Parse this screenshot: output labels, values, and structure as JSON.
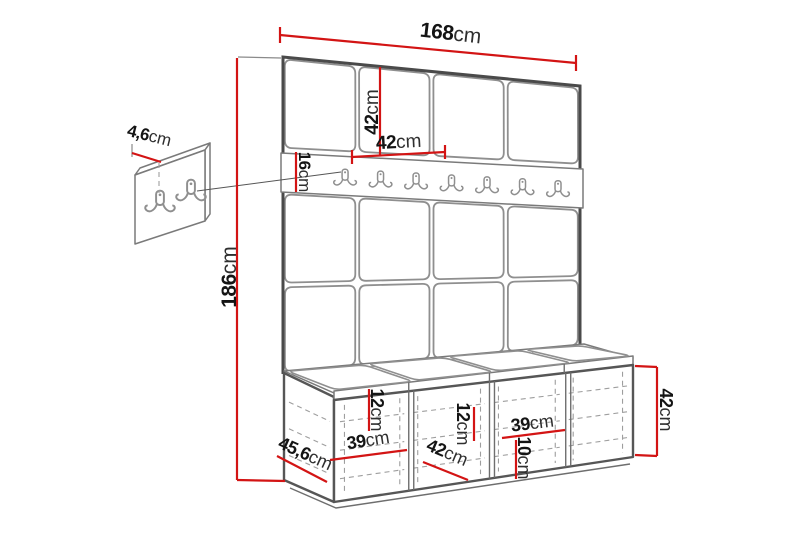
{
  "diagram": {
    "type": "furniture-dimension-diagram",
    "accent_color": "#d31414",
    "outline_color": "#4a4a4a",
    "hook_rail": {
      "hook_count": 7
    },
    "detail_panel": {
      "hook_count": 2
    }
  },
  "dims": {
    "total_width": {
      "num": "168",
      "unit": "cm"
    },
    "total_height": {
      "num": "186",
      "unit": "cm"
    },
    "panel_height": {
      "num": "42",
      "unit": "cm"
    },
    "panel_width": {
      "num": "42",
      "unit": "cm"
    },
    "rail_height": {
      "num": "16",
      "unit": "cm"
    },
    "panel_thickness": {
      "num": "4,6",
      "unit": "cm"
    },
    "bench_depth": {
      "num": "45,6",
      "unit": "cm"
    },
    "cushion_height_1": {
      "num": "12",
      "unit": "cm"
    },
    "compartment_width_1": {
      "num": "39",
      "unit": "cm"
    },
    "seat_width": {
      "num": "42",
      "unit": "cm"
    },
    "cushion_height_2": {
      "num": "12",
      "unit": "cm"
    },
    "compartment_width_2": {
      "num": "39",
      "unit": "cm"
    },
    "shelf_height": {
      "num": "10",
      "unit": "cm"
    },
    "bench_height": {
      "num": "42",
      "unit": "cm"
    }
  }
}
